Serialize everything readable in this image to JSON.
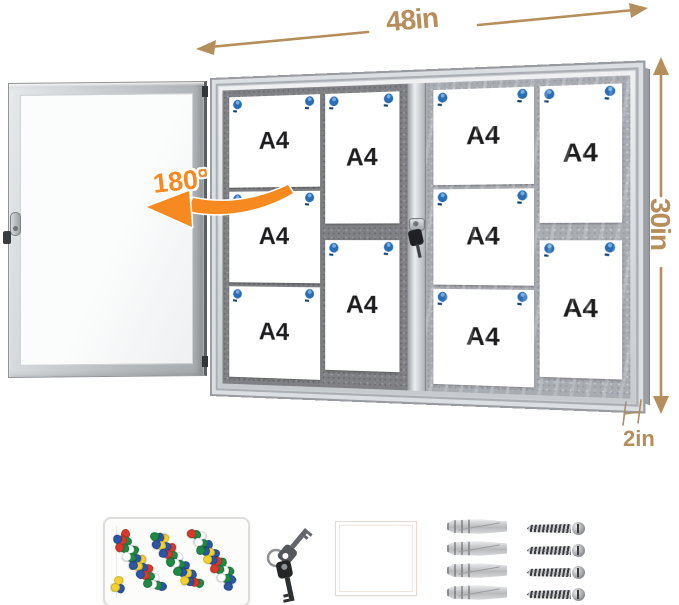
{
  "annotations": {
    "width_label": "48in",
    "height_label": "30in",
    "depth_label": "2in",
    "swing_label": "180°",
    "dimension_color": "#b58e5c",
    "swing_color": "#f6891f"
  },
  "cabinet": {
    "sheet_count": 10,
    "pin_color": "#2a6db5",
    "compartments": [
      {
        "name": "left",
        "columns": [
          {
            "sheets": [
              "A4",
              "A4",
              "A4"
            ]
          },
          {
            "sheets": [
              "A4",
              "A4"
            ]
          }
        ]
      },
      {
        "name": "right",
        "columns": [
          {
            "sheets": [
              "A4",
              "A4",
              "A4"
            ]
          },
          {
            "sheets": [
              "A4",
              "A4"
            ]
          }
        ]
      }
    ]
  },
  "accessories": {
    "pushpin_colors": [
      "#d8392b",
      "#2b55a5",
      "#1e8a44",
      "#f4d22b",
      "#ffffff",
      "#2b55a5",
      "#1e8a44"
    ],
    "keys_count": 2,
    "anchors_count": 4,
    "screws_count": 4
  }
}
